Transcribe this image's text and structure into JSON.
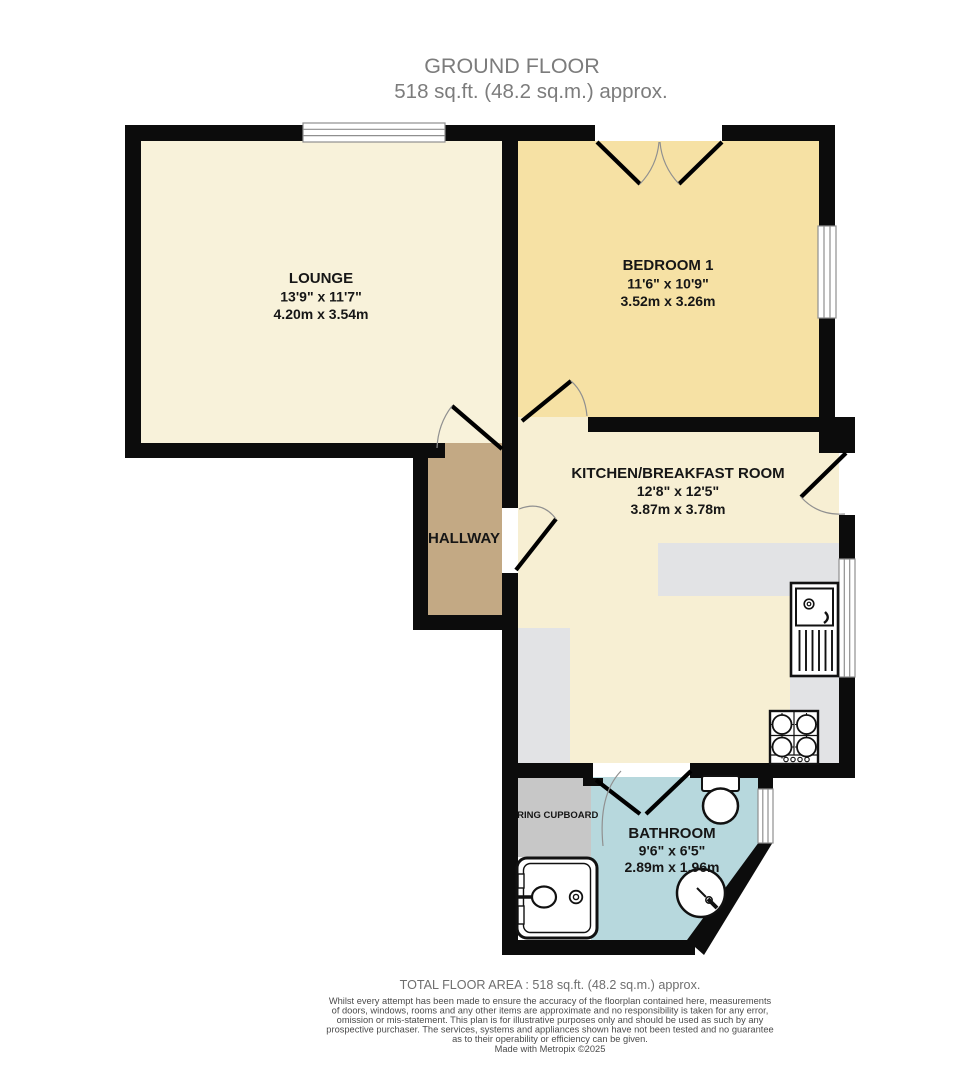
{
  "title": {
    "line1": "GROUND FLOOR",
    "line2": "518 sq.ft. (48.2 sq.m.) approx."
  },
  "rooms": {
    "lounge": {
      "name": "LOUNGE",
      "dims_imperial": "13'9\" x 11'7\"",
      "dims_metric": "4.20m x 3.54m"
    },
    "bedroom1": {
      "name": "BEDROOM 1",
      "dims_imperial": "11'6\" x 10'9\"",
      "dims_metric": "3.52m x 3.26m"
    },
    "kitchen": {
      "name": "KITCHEN/BREAKFAST ROOM",
      "dims_imperial": "12'8\" x 12'5\"",
      "dims_metric": "3.87m x 3.78m"
    },
    "hallway": {
      "name": "HALLWAY"
    },
    "bathroom": {
      "name": "BATHROOM",
      "dims_imperial": "9'6\" x 6'5\"",
      "dims_metric": "2.89m x 1.96m"
    },
    "airing_cupboard": {
      "name": "AIRING CUPBOARD"
    }
  },
  "footer": {
    "total_area": "TOTAL FLOOR AREA : 518 sq.ft. (48.2 sq.m.) approx.",
    "disclaimer_lines": [
      "Whilst every attempt has been made to ensure the accuracy of the floorplan contained here, measurements",
      "of doors, windows, rooms and any other items are approximate and no responsibility is taken for any error,",
      "omission or mis-statement. This plan is for illustrative purposes only and should be used as such by any",
      "prospective purchaser. The services, systems and appliances shown have not been tested and no guarantee",
      "as to their operability or efficiency can be given."
    ],
    "credit": "Made with Metropix ©2025"
  },
  "colors": {
    "wall": "#0c0c0c",
    "lounge_fill": "#F8F2DA",
    "bedroom_fill": "#F6E1A4",
    "kitchen_fill": "#F7EFD3",
    "hallway_fill": "#C3A984",
    "bathroom_fill": "#B7D8DD",
    "airing_fill": "#C7C7C7",
    "counter_fill": "#E2E3E5",
    "title_text": "#7c7c7c",
    "label_text": "#161616"
  }
}
